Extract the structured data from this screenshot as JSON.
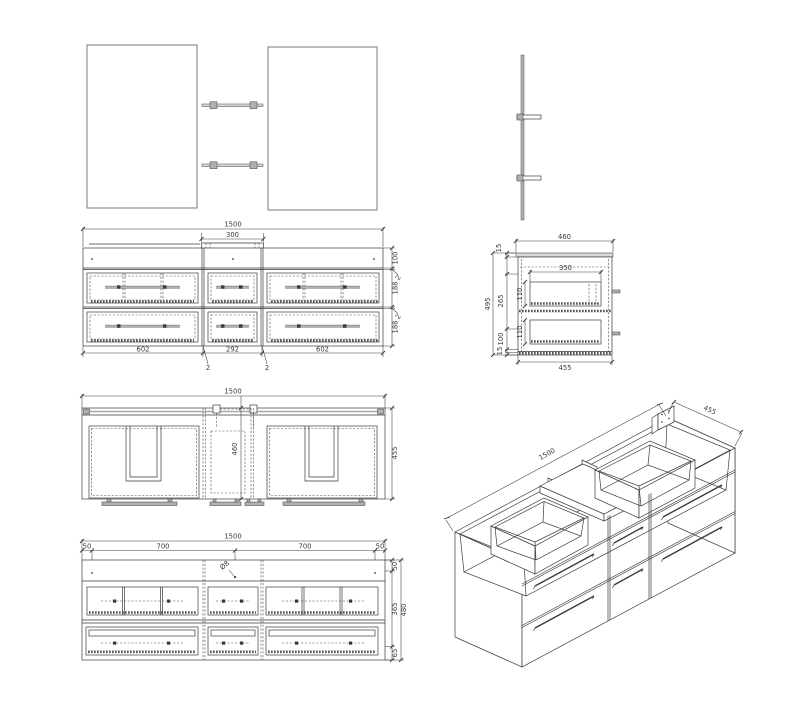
{
  "colors": {
    "background": "#ffffff",
    "line": "#3a3a3a",
    "hardware": "#b0b0b0",
    "surface": "#d9d9d9"
  },
  "views": {
    "front_elevation": {
      "total_width": "1500",
      "basin_width": "300",
      "right_top_rail": "100",
      "right_gap_upper": "2",
      "right_drawer_upper": "188",
      "right_gap_lower": "2",
      "right_drawer_lower": "188",
      "bottom_left": "602",
      "bottom_center": "292",
      "bottom_right": "602",
      "partition_left": "2",
      "partition_right": "2"
    },
    "side_section": {
      "top_width": "460",
      "counter_thickness": "15",
      "overall_height": "495",
      "mid_height": "265",
      "lower_height": "100",
      "bottom_thickness": "15",
      "drawer_box_width": "350",
      "upper_drawer_height": "110",
      "lower_drawer_height": "110",
      "bottom_width": "455"
    },
    "plan_section": {
      "total_width": "1500",
      "center_depth": "460",
      "overall_depth": "455"
    },
    "rear_elevation": {
      "total_width": "1500",
      "edge_left": "50",
      "span_left": "700",
      "span_right": "700",
      "edge_right": "50",
      "top_height": "50",
      "mid_height": "365",
      "bottom_height": "65",
      "overall_height": "480",
      "hole_diameter": "Ø8"
    },
    "isometric": {
      "length": "1500",
      "depth": "455"
    }
  }
}
